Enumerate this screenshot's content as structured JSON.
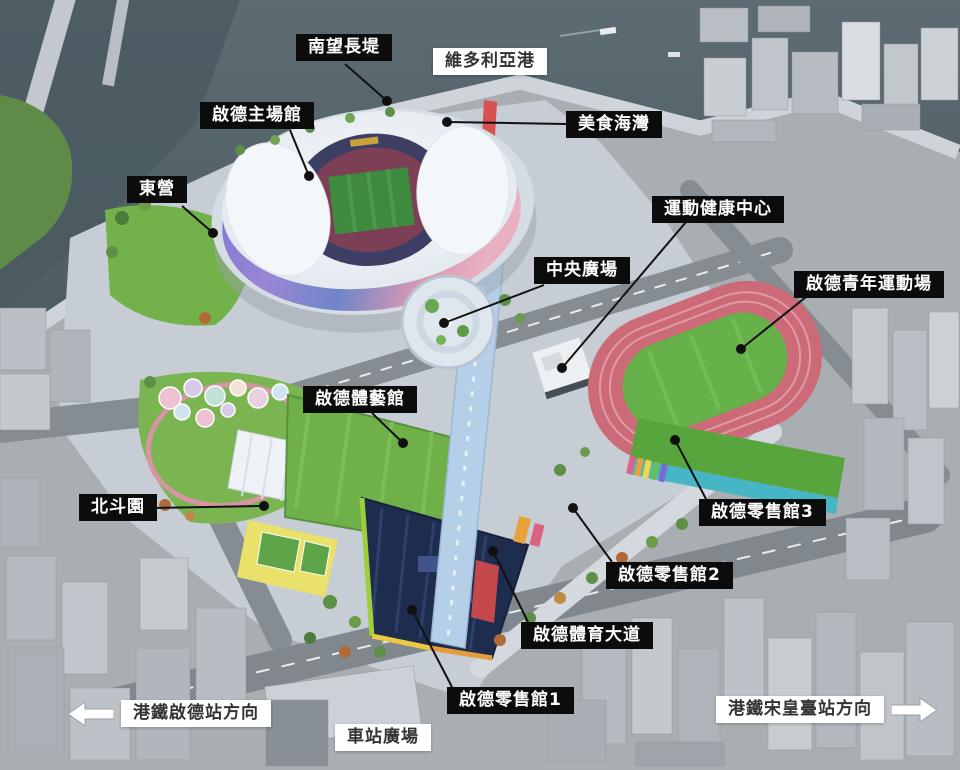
{
  "colors": {
    "callout_bg": "#0c0c0c",
    "callout_text": "#ffffff",
    "area_label_bg": "#ffffff",
    "area_label_text": "#333333",
    "line": "#111111",
    "arrow_fill": "#ffffff",
    "arrow_stroke": "#9aa0a6"
  },
  "annotations": {
    "callouts": [
      {
        "id": "south-promenade",
        "text": "南望長堤",
        "bx": 296,
        "by": 34,
        "lx": 345,
        "ly": 64,
        "dx": 387,
        "dy": 101
      },
      {
        "id": "kai-tak-main-stadium",
        "text": "啟德主場館",
        "bx": 200,
        "by": 102,
        "lx": 290,
        "ly": 130,
        "dx": 309,
        "dy": 176
      },
      {
        "id": "dining-cove",
        "text": "美食海灣",
        "bx": 566,
        "by": 111,
        "lx": 566,
        "ly": 124,
        "dx": 447,
        "dy": 122
      },
      {
        "id": "tung-ying-lawn",
        "text": "東營",
        "bx": 127,
        "by": 176,
        "lx": 182,
        "ly": 206,
        "dx": 213,
        "dy": 233
      },
      {
        "id": "health-wellness-centre",
        "text": "運動健康中心",
        "bx": 652,
        "by": 196,
        "lx": 686,
        "ly": 222,
        "dx": 562,
        "dy": 368
      },
      {
        "id": "central-square",
        "text": "中央廣場",
        "bx": 534,
        "by": 257,
        "lx": 544,
        "ly": 285,
        "dx": 444,
        "dy": 323
      },
      {
        "id": "youth-sports-ground",
        "text": "啟德青年運動場",
        "bx": 794,
        "by": 271,
        "lx": 806,
        "ly": 297,
        "dx": 741,
        "dy": 349
      },
      {
        "id": "kai-tak-arena",
        "text": "啟德體藝館",
        "bx": 303,
        "by": 386,
        "lx": 372,
        "ly": 413,
        "dx": 403,
        "dy": 443
      },
      {
        "id": "pak-tau-garden",
        "text": "北斗園",
        "bx": 79,
        "by": 494,
        "lx": 152,
        "ly": 508,
        "dx": 264,
        "dy": 506
      },
      {
        "id": "retail-hall-3",
        "text": "啟德零售館3",
        "bx": 699,
        "by": 499,
        "lx": 706,
        "ly": 499,
        "dx": 675,
        "dy": 440
      },
      {
        "id": "retail-hall-2",
        "text": "啟德零售館2",
        "bx": 606,
        "by": 562,
        "lx": 612,
        "ly": 562,
        "dx": 573,
        "dy": 508
      },
      {
        "id": "sports-avenue",
        "text": "啟德體育大道",
        "bx": 521,
        "by": 622,
        "lx": 528,
        "ly": 622,
        "dx": 493,
        "dy": 551
      },
      {
        "id": "retail-hall-1",
        "text": "啟德零售館1",
        "bx": 447,
        "by": 687,
        "lx": 452,
        "ly": 687,
        "dx": 412,
        "dy": 610
      }
    ],
    "area_labels": [
      {
        "id": "victoria-harbour",
        "text": "維多利亞港",
        "bx": 433,
        "by": 48
      },
      {
        "id": "station-square",
        "text": "車站廣場",
        "bx": 335,
        "by": 724
      }
    ],
    "direction_signs": [
      {
        "id": "mtr-kai-tak-station",
        "text": "港鐵啟德站方向",
        "dir": "left",
        "bx": 68,
        "by": 700
      },
      {
        "id": "mtr-sung-wong-toi-station",
        "text": "港鐵宋皇臺站方向",
        "dir": "right",
        "bx": 716,
        "by": 696
      }
    ]
  }
}
